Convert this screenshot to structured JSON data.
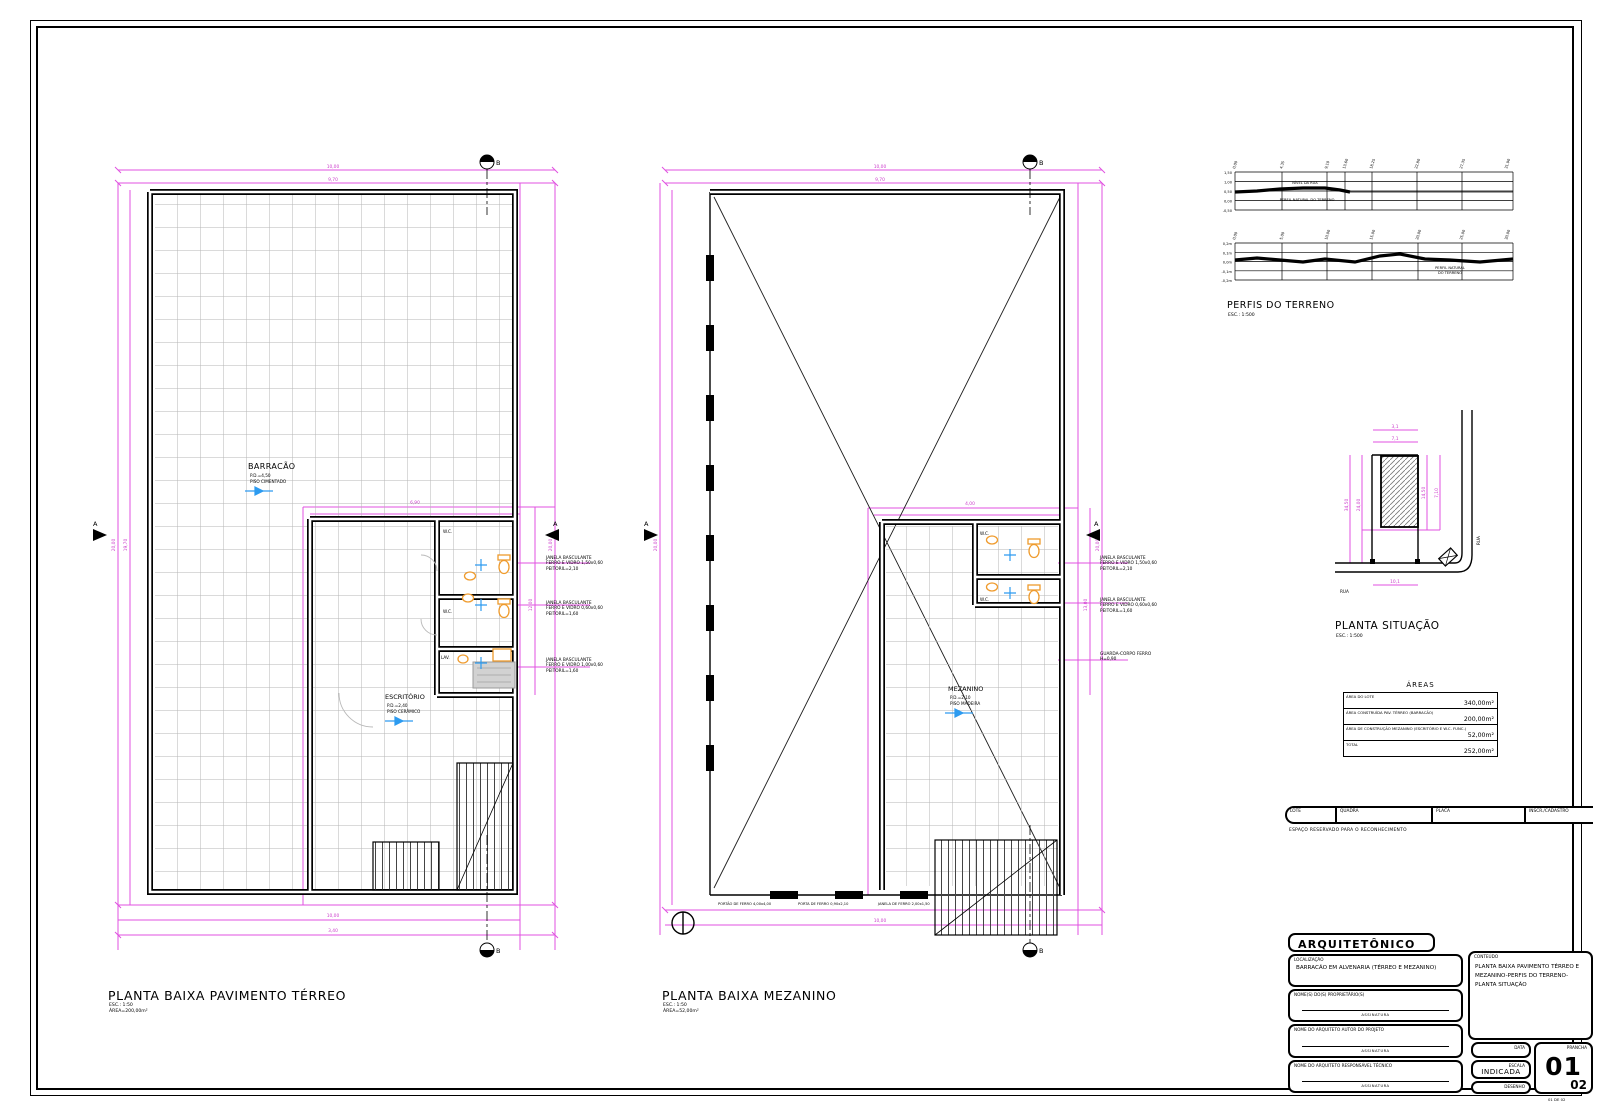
{
  "plans": {
    "terreo": {
      "title": "PLANTA BAIXA PAVIMENTO TÉRREO",
      "scale": "ESC.: 1:50",
      "area": "ÁREA=200,00m²",
      "room": "BARRACÃO",
      "room_note1": "P.D.=4,50",
      "room_note2": "PISO CIMENTADO",
      "office": "ESCRITÓRIO",
      "office_note1": "P.D.=2,40",
      "office_note2": "PISO CERÂMICO",
      "wc1": "W.C.",
      "wc2": "W.C.",
      "lav": "LAV.",
      "section_top": "B",
      "section_bottom": "B",
      "section_left": "A",
      "section_right": "A",
      "notes": [
        {
          "l1": "JANELA BASCULANTE",
          "l2": "FERRO E VIDRO 1,50x0,60",
          "l3": "PEITORIL=2,10"
        },
        {
          "l1": "JANELA BASCULANTE",
          "l2": "FERRO E VIDRO 0,60x0,60",
          "l3": "PEITORIL=1,60"
        },
        {
          "l1": "JANELA BASCULANTE",
          "l2": "FERRO E VIDRO 1,00x0,60",
          "l3": "PEITORIL=1,60"
        }
      ],
      "dims": {
        "top1": "10,00",
        "top2": "9,70",
        "left1": "20,00",
        "left2": "19,70",
        "right1": "20,00",
        "annex_t": "6,90",
        "annex_r": "12,00",
        "bot1": "10,00",
        "bot2": "3,40"
      }
    },
    "mezanino": {
      "title": "PLANTA BAIXA MEZANINO",
      "scale": "ESC.: 1:50",
      "area": "ÁREA=52,00m²",
      "room": "MEZANINO",
      "room_note1": "P.D.=2,10",
      "room_note2": "PISO MADEIRA",
      "wc1": "W.C.",
      "wc2": "W.C.",
      "section_top": "B",
      "section_bottom": "B",
      "section_left": "A",
      "section_right": "A",
      "notes": [
        {
          "l1": "JANELA BASCULANTE",
          "l2": "FERRO E VIDRO 1,50x0,60",
          "l3": "PEITORIL=2,10"
        },
        {
          "l1": "JANELA BASCULANTE",
          "l2": "FERRO E VIDRO 0,60x0,60",
          "l3": "PEITORIL=1,60"
        },
        {
          "l1": "GUARDA-CORPO FERRO",
          "l2": "H=0,90",
          "l3": ""
        }
      ],
      "bottom_notes": [
        "PORTÃO DE FERRO 4,00x4,00",
        "PORTA DE FERRO 0,90x2,10",
        "JANELA DE FERRO 2,00x1,50"
      ],
      "dims": {
        "top1": "10,00",
        "top2": "9,70",
        "left1": "20,00",
        "right1": "20,00",
        "mezz_t": "4,00",
        "mezz_r": "13,00",
        "bot1": "10,00"
      }
    }
  },
  "perfis": {
    "title": "PERFIS DO TERRENO",
    "scale": "ESC.: 1:500",
    "p1_left": [
      "1,50",
      "1,00",
      "0,50",
      "0,00",
      "-0,50"
    ],
    "p1_ticks": [
      "0,00",
      "4,35",
      "9,10",
      "13,60",
      "18,25",
      "22,80",
      "27,35",
      "31,90"
    ],
    "p1_points": "40,42 62,41 85,39 108,38 130,38 145,40 155,42",
    "p1_note1": "NÍVEL DA RUA",
    "p1_note2": "PERFIL NATURAL DO TERRENO",
    "p2_left": [
      "0,2m",
      "0,1m",
      "0,0m",
      "-0,1m",
      "-0,2m"
    ],
    "p2_ticks": [
      "0,00",
      "5,00",
      "10,00",
      "15,00",
      "20,00",
      "25,00",
      "30,00"
    ],
    "p2_points": "40,110 62,108 85,110 108,112 130,109 160,112 185,106 205,104 230,109 255,110 285,112 318,109",
    "p2_note1": "PERFIL NATURAL",
    "p2_note2": "DO TERRENO"
  },
  "situacao": {
    "title": "PLANTA SITUAÇÃO",
    "scale": "ESC.: 1:500",
    "rua_vertical": "RUA",
    "rua_horizontal": "RUA",
    "dims": {
      "t1": "3,1",
      "t2": "7,1",
      "l1": "34,50",
      "l2": "24,00",
      "r1": "14,50",
      "r2": "7,10",
      "b1": "10,1"
    }
  },
  "areas": {
    "title": "ÁREAS",
    "rows": [
      {
        "label": "ÁREA DO LOTE",
        "value": "340,00m²"
      },
      {
        "label": "ÁREA CONSTRUÍDA PAV. TÉRREO (BARRACÃO)",
        "value": "200,00m²"
      },
      {
        "label": "ÁREA DE CONSTRUÇÃO MEZANINO (ESCRITÓRIO E W.C. FUNC.)",
        "value": "52,00m²"
      },
      {
        "label": "TOTAL",
        "value": "252,00m²"
      }
    ]
  },
  "cadastro": {
    "cells": [
      "LOTE",
      "QUADRA",
      "PLACA",
      "INSCR./CADASTRO"
    ],
    "note": "ESPAÇO RESERVADO PARA O RECONHECIMENTO"
  },
  "titleblock": {
    "header": "ARQUITETÔNICO",
    "loc_label": "LOCALIZAÇÃO",
    "loc_value": "BARRACÃO EM ALVENARIA (TÉRREO E MEZANINO)",
    "owner_label": "NOME(S) DO(S) PROPRIETÁRIO(S)",
    "author_label": "NOME DO ARQUITETO AUTOR DO PROJETO",
    "resp_label": "NOME DO ARQUITETO RESPONSÁVEL TÉCNICO",
    "signature": "ASSINATURA",
    "content_label": "CONTEÚDO",
    "content_l1": "PLANTA BAIXA PAVIMENTO TÉRREO E",
    "content_l2": "MEZANINO-PERFIS DO TERRENO-",
    "content_l3": "PLANTA SITUAÇÃO",
    "data_label": "DATA",
    "escala_label": "ESCALA",
    "escala_value": "INDICADA",
    "desenho_label": "DESENHO",
    "prancha_label": "PRANCHA",
    "sheet_number": "01",
    "sheet_total": "02",
    "corner_note": "01 DE 02"
  },
  "colors": {
    "dimension": "#e052e0",
    "grid": "#b5b5b5",
    "fixture": "#ef9b2d",
    "marker": "#2d9bf0"
  }
}
